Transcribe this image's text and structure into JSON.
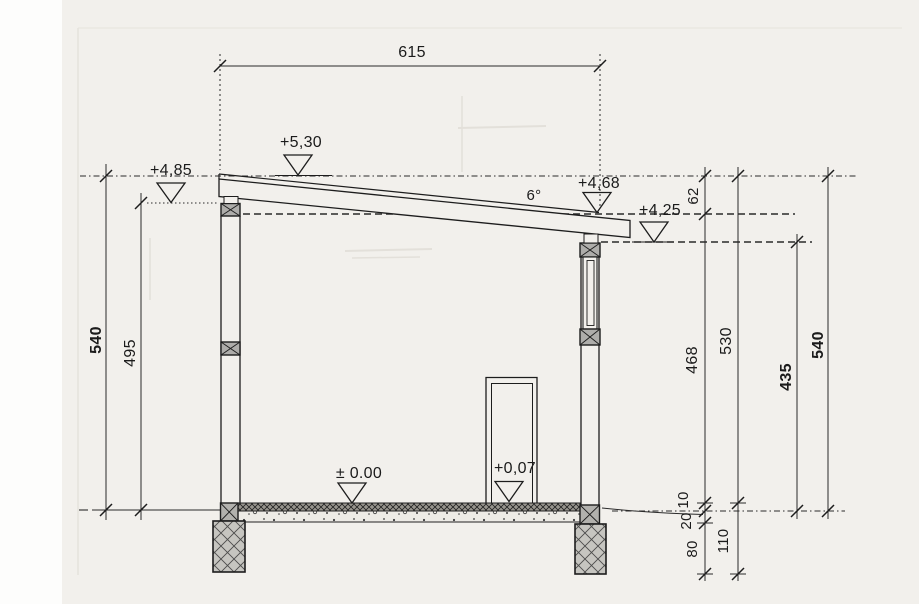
{
  "drawing": {
    "top_dim": "615",
    "left_dims": [
      {
        "value": "540"
      },
      {
        "value": "495"
      }
    ],
    "right_dims": [
      {
        "value": "62"
      },
      {
        "value": "468"
      },
      {
        "value": "530"
      },
      {
        "value": "435"
      },
      {
        "value": "540"
      }
    ],
    "bottom_dims": [
      {
        "value": "10"
      },
      {
        "value": "20"
      },
      {
        "value": "80"
      },
      {
        "value": "110"
      }
    ],
    "levels": [
      {
        "label": "+5,30"
      },
      {
        "label": "+4,85"
      },
      {
        "label": "+4,68"
      },
      {
        "label": "+4,25"
      },
      {
        "label": "± 0.00"
      },
      {
        "label": "+0,07"
      }
    ],
    "roof_angle": "6°"
  }
}
